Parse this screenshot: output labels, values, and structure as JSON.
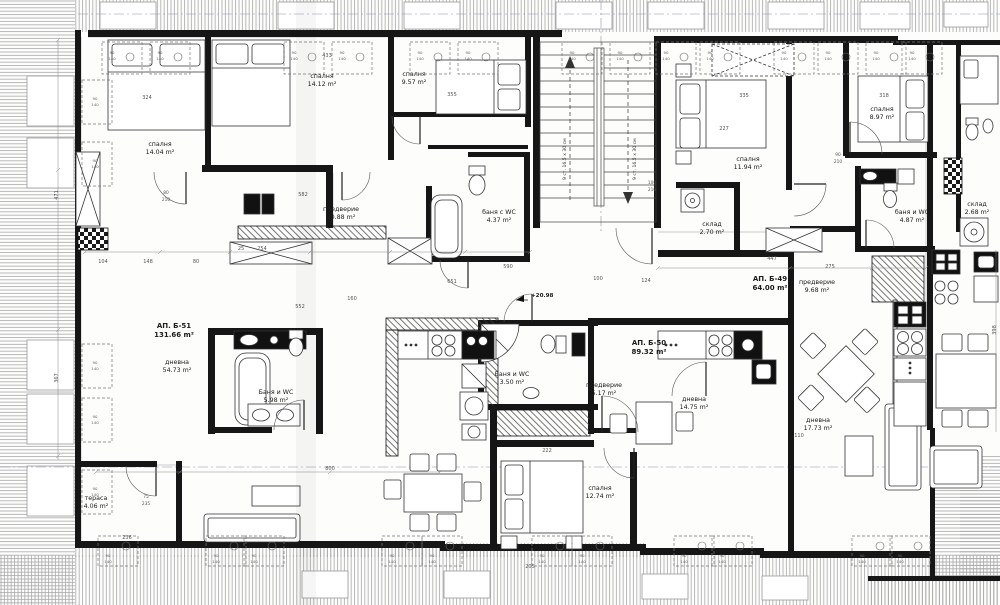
{
  "drawing": {
    "type": "apartment-floor-plan",
    "language": "bg",
    "apartments": [
      {
        "id": "b51",
        "label": "АП. Б-51",
        "area": "131.66 m²"
      },
      {
        "id": "b50",
        "label": "АП. Б-50",
        "area": "89.32 m²"
      },
      {
        "id": "b49",
        "label": "АП. Б-49",
        "area": "64.00 m²"
      }
    ],
    "rooms": [
      {
        "id": "r-bed-1",
        "name": "спалня",
        "area": "14.04 m²"
      },
      {
        "id": "r-bed-2",
        "name": "спалня",
        "area": "14.12 m²"
      },
      {
        "id": "r-bed-3",
        "name": "спалня",
        "area": "9.57 m²"
      },
      {
        "id": "r-hall-1",
        "name": "предверие",
        "area": "10.88 m²"
      },
      {
        "id": "r-bath-1",
        "name": "баня с WC",
        "area": "4.37 m²"
      },
      {
        "id": "r-living-1",
        "name": "дневна",
        "area": "54.73 m²"
      },
      {
        "id": "r-bath-2",
        "name": "Баня и WC",
        "area": "5.98 m²"
      },
      {
        "id": "r-bed-4",
        "name": "спалня",
        "area": "11.94 m²"
      },
      {
        "id": "r-store-1",
        "name": "склад",
        "area": "2.70 m²"
      },
      {
        "id": "r-bed-5",
        "name": "спалня",
        "area": "8.97 m²"
      },
      {
        "id": "r-bath-3",
        "name": "баня и WC",
        "area": "4.87 m²"
      },
      {
        "id": "r-store-2",
        "name": "склад",
        "area": "2.68 m²"
      },
      {
        "id": "r-hall-2",
        "name": "предверие",
        "area": "9.68 m²"
      },
      {
        "id": "r-hall-3",
        "name": "предверие",
        "area": "5.17 m²"
      },
      {
        "id": "r-living-2",
        "name": "дневна",
        "area": "14.75 m²"
      },
      {
        "id": "r-bath-4",
        "name": "Баня и WC",
        "area": "3.50 m²"
      },
      {
        "id": "r-bed-6",
        "name": "спалня",
        "area": "12.74 m²"
      },
      {
        "id": "r-living-3",
        "name": "дневна",
        "area": "17.73 m²"
      },
      {
        "id": "r-terrace",
        "name": "тераса",
        "area": "4.06 m²"
      }
    ],
    "stairs": {
      "flight_note": "9 ст. 16.5 x 30 см",
      "flights": 2
    },
    "elevation_mark": "+20.98",
    "window_size": {
      "w": "90",
      "h": "140"
    },
    "door_sizes": [
      {
        "w": "80",
        "h": "210"
      },
      {
        "w": "90",
        "h": "210"
      },
      {
        "w": "100",
        "h": "210"
      },
      {
        "w": "75",
        "h": "235"
      }
    ],
    "dims": [
      "324",
      "433",
      "355",
      "318",
      "227",
      "335",
      "582",
      "651",
      "552",
      "104",
      "148",
      "80",
      "100",
      "124",
      "447",
      "471",
      "367",
      "236",
      "800",
      "222",
      "590",
      "110",
      "254",
      "25",
      "160",
      "275",
      "398",
      "205"
    ]
  }
}
